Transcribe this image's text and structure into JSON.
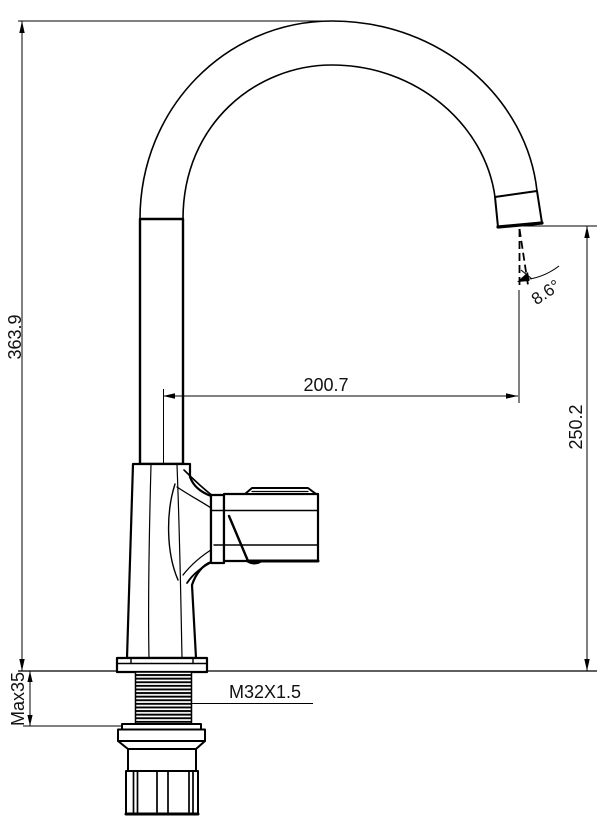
{
  "drawing": {
    "background_color": "#ffffff",
    "line_color": "#000000"
  },
  "dimensions": {
    "total_height": "363.9",
    "spout_reach": "200.7",
    "outlet_height": "250.2",
    "outlet_angle": "8.6°",
    "max_mounting_thickness": "Max35",
    "thread_spec": "M32X1.5"
  }
}
